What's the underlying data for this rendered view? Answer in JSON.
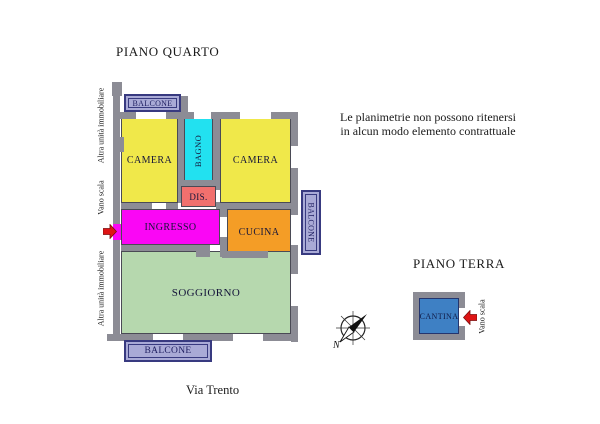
{
  "titles": {
    "piano_quarto": "PIANO QUARTO",
    "piano_terra": "PIANO TERRA",
    "street": "Via Trento"
  },
  "disclaimer": {
    "line1": "Le planimetrie non possono ritenersi",
    "line2": "in alcun modo elemento contrattuale"
  },
  "side_labels": {
    "altra_top": "Altra unità immobiliare",
    "vano_scala_left": "Vano scala",
    "altra_bottom": "Altra unità immobiliare",
    "vano_scala_right": "Vano scala"
  },
  "rooms": {
    "camera1": {
      "label": "CAMERA",
      "color": "#F0E84A"
    },
    "bagno": {
      "label": "BAGNO",
      "color": "#22E1F0"
    },
    "camera2": {
      "label": "CAMERA",
      "color": "#F0E84A"
    },
    "dis": {
      "label": "DIS.",
      "color": "#F2706E"
    },
    "ingresso": {
      "label": "INGRESSO",
      "color": "#FA06F5"
    },
    "cucina": {
      "label": "CUCINA",
      "color": "#F49D26"
    },
    "soggiorno": {
      "label": "SOGGIORNO",
      "color": "#B6D8AE"
    },
    "balcone_top": {
      "label": "BALCONE",
      "color": "#A9AAD6"
    },
    "balcone_right": {
      "label": "BALCONE",
      "color": "#A9AAD6"
    },
    "balcone_bottom": {
      "label": "BALCONE",
      "color": "#A9AAD6"
    },
    "cantina": {
      "label": "CANTINA",
      "color": "#3E80C4"
    }
  },
  "compass": {
    "north": "N"
  },
  "colors": {
    "wall": "#8C8C95",
    "balcone_border": "#383A80",
    "cantina_border": "#24356E",
    "arrow_red": "#DE1414",
    "label_text": "#15153A"
  }
}
